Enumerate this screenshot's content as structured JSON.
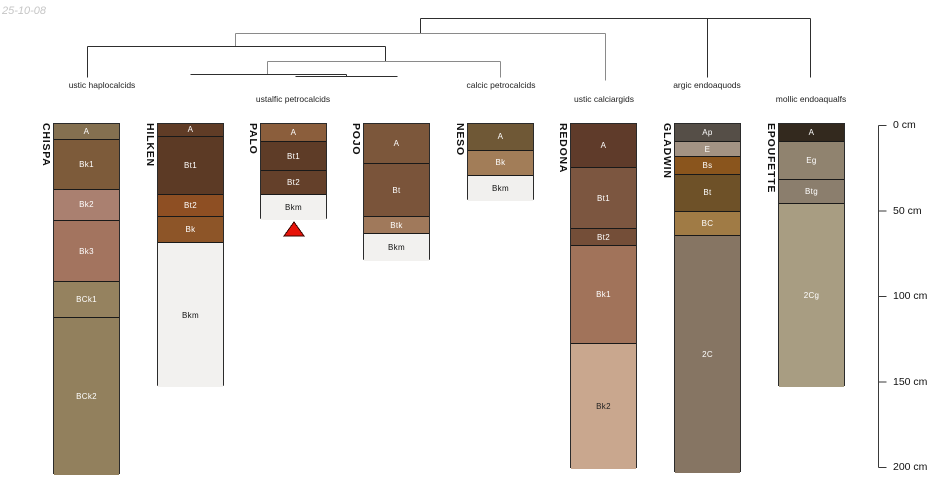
{
  "meta": {
    "date_label": "25-10-08"
  },
  "chart_data": {
    "type": "dendrogram-soil-profiles",
    "title": "",
    "layout": {
      "profiles_top_px": 123,
      "px_per_cm": 1.71,
      "column_width_px": 67,
      "line_colors": {
        "dark": "#2e2e2e",
        "gray": "#8a8a8a"
      }
    },
    "dendrogram": {
      "segments": [
        {
          "x1": 420,
          "y1": 18,
          "x2": 810,
          "y2": 18,
          "c": "dark"
        },
        {
          "x1": 420,
          "y1": 18,
          "x2": 420,
          "y2": 33,
          "c": "dark"
        },
        {
          "x1": 707,
          "y1": 18,
          "x2": 707,
          "y2": 77,
          "c": "dark"
        },
        {
          "x1": 810,
          "y1": 18,
          "x2": 810,
          "y2": 77,
          "c": "dark"
        },
        {
          "x1": 235,
          "y1": 33,
          "x2": 605,
          "y2": 33,
          "c": "gray"
        },
        {
          "x1": 235,
          "y1": 33,
          "x2": 235,
          "y2": 46,
          "c": "gray"
        },
        {
          "x1": 605,
          "y1": 33,
          "x2": 605,
          "y2": 80,
          "c": "gray"
        },
        {
          "x1": 87,
          "y1": 46,
          "x2": 385,
          "y2": 46,
          "c": "dark"
        },
        {
          "x1": 87,
          "y1": 46,
          "x2": 87,
          "y2": 77,
          "c": "dark"
        },
        {
          "x1": 385,
          "y1": 46,
          "x2": 385,
          "y2": 61,
          "c": "dark"
        },
        {
          "x1": 267,
          "y1": 61,
          "x2": 500,
          "y2": 61,
          "c": "gray"
        },
        {
          "x1": 500,
          "y1": 61,
          "x2": 500,
          "y2": 77,
          "c": "gray"
        },
        {
          "x1": 267,
          "y1": 61,
          "x2": 267,
          "y2": 74,
          "c": "gray"
        },
        {
          "x1": 190,
          "y1": 74,
          "x2": 346,
          "y2": 74,
          "c": "dark"
        },
        {
          "x1": 346,
          "y1": 74,
          "x2": 346,
          "y2": 76,
          "c": "dark"
        },
        {
          "x1": 295,
          "y1": 76,
          "x2": 397,
          "y2": 76,
          "c": "dark"
        }
      ]
    },
    "taxa": [
      {
        "label": "ustic haplocalcids",
        "cx": 102,
        "row": 0
      },
      {
        "label": "ustalfic petrocalcids",
        "cx": 293,
        "row": 1
      },
      {
        "label": "calcic petrocalcids",
        "cx": 501,
        "row": 0
      },
      {
        "label": "ustic calciargids",
        "cx": 604,
        "row": 1
      },
      {
        "label": "argic endoaquods",
        "cx": 707,
        "row": 0
      },
      {
        "label": "mollic endoaqualfs",
        "cx": 811,
        "row": 1
      }
    ],
    "taxa_row_tops": [
      80,
      94
    ],
    "profiles": [
      {
        "name": "CHISPA",
        "x": 53,
        "bottom_style": "soil",
        "horizons": [
          {
            "n": "A",
            "t": 0,
            "b": 9,
            "c": "#847050",
            "tc": "#ffffff"
          },
          {
            "n": "Bk1",
            "t": 9,
            "b": 38,
            "c": "#7d5b3a",
            "tc": "#ffffff"
          },
          {
            "n": "Bk2",
            "t": 38,
            "b": 56,
            "c": "#aa8070",
            "tc": "#ffffff"
          },
          {
            "n": "Bk3",
            "t": 56,
            "b": 92,
            "c": "#a3745f",
            "tc": "#ffffff"
          },
          {
            "n": "BCk1",
            "t": 92,
            "b": 113,
            "c": "#95825f",
            "tc": "#ffffff"
          },
          {
            "n": "BCk2",
            "t": 113,
            "b": 205,
            "c": "#92805d",
            "tc": "#ffffff"
          }
        ]
      },
      {
        "name": "HILKEN",
        "x": 157,
        "bottom_style": "bkm",
        "horizons": [
          {
            "n": "A",
            "t": 0,
            "b": 7,
            "c": "#603c26",
            "tc": "#ffffff"
          },
          {
            "n": "Bt1",
            "t": 7,
            "b": 41,
            "c": "#5c3a25",
            "tc": "#ffffff"
          },
          {
            "n": "Bt2",
            "t": 41,
            "b": 54,
            "c": "#8e4f23",
            "tc": "#ffffff"
          },
          {
            "n": "Bk",
            "t": 54,
            "b": 69,
            "c": "#8d5528",
            "tc": "#ffffff"
          },
          {
            "n": "Bkm",
            "t": 69,
            "b": 154,
            "c": "#f2f1ef",
            "tc": "#111111"
          }
        ]
      },
      {
        "name": "PALO",
        "x": 260,
        "bottom_style": "bkm",
        "horizons": [
          {
            "n": "A",
            "t": 0,
            "b": 10,
            "c": "#8b5e3c",
            "tc": "#ffffff"
          },
          {
            "n": "Bt1",
            "t": 10,
            "b": 27,
            "c": "#5e3c27",
            "tc": "#ffffff"
          },
          {
            "n": "Bt2",
            "t": 27,
            "b": 41,
            "c": "#64402a",
            "tc": "#ffffff"
          },
          {
            "n": "Bkm",
            "t": 41,
            "b": 56,
            "c": "#f2f1ef",
            "tc": "#111111"
          }
        ]
      },
      {
        "name": "POJO",
        "x": 363,
        "bottom_style": "bkm",
        "horizons": [
          {
            "n": "A",
            "t": 0,
            "b": 23,
            "c": "#7c573b",
            "tc": "#ffffff"
          },
          {
            "n": "Bt",
            "t": 23,
            "b": 54,
            "c": "#7a543a",
            "tc": "#ffffff"
          },
          {
            "n": "Btk",
            "t": 54,
            "b": 64,
            "c": "#a0795b",
            "tc": "#ffffff"
          },
          {
            "n": "Bkm",
            "t": 64,
            "b": 80,
            "c": "#f2f1ef",
            "tc": "#111111"
          }
        ]
      },
      {
        "name": "NESO",
        "x": 467,
        "bottom_style": "bkm",
        "horizons": [
          {
            "n": "A",
            "t": 0,
            "b": 15,
            "c": "#6f5836",
            "tc": "#ffffff"
          },
          {
            "n": "Bk",
            "t": 15,
            "b": 30,
            "c": "#a27d58",
            "tc": "#ffffff"
          },
          {
            "n": "Bkm",
            "t": 30,
            "b": 45,
            "c": "#f1f0ee",
            "tc": "#111111"
          }
        ]
      },
      {
        "name": "REDONA",
        "x": 570,
        "bottom_style": "soil",
        "horizons": [
          {
            "n": "A",
            "t": 0,
            "b": 25,
            "c": "#5f3b2a",
            "tc": "#ffffff"
          },
          {
            "n": "Bt1",
            "t": 25,
            "b": 61,
            "c": "#7c5640",
            "tc": "#ffffff"
          },
          {
            "n": "Bt2",
            "t": 61,
            "b": 71,
            "c": "#744e38",
            "tc": "#ffffff"
          },
          {
            "n": "Bk1",
            "t": 71,
            "b": 128,
            "c": "#a1735a",
            "tc": "#ffffff"
          },
          {
            "n": "Bk2",
            "t": 128,
            "b": 202,
            "c": "#c9a78e",
            "tc": "#222222"
          }
        ]
      },
      {
        "name": "GLADWIN",
        "x": 674,
        "bottom_style": "soil",
        "horizons": [
          {
            "n": "Ap",
            "t": 0,
            "b": 10,
            "c": "#554e47",
            "tc": "#ffffff"
          },
          {
            "n": "E",
            "t": 10,
            "b": 19,
            "c": "#a39384",
            "tc": "#ffffff"
          },
          {
            "n": "Bs",
            "t": 19,
            "b": 29,
            "c": "#8a551d",
            "tc": "#ffffff"
          },
          {
            "n": "Bt",
            "t": 29,
            "b": 51,
            "c": "#6e5128",
            "tc": "#ffffff"
          },
          {
            "n": "BC",
            "t": 51,
            "b": 65,
            "c": "#a07b45",
            "tc": "#ffffff"
          },
          {
            "n": "2C",
            "t": 65,
            "b": 204,
            "c": "#867563",
            "tc": "#ffffff"
          }
        ]
      },
      {
        "name": "EPOUFETTE",
        "x": 778,
        "bottom_style": "soil",
        "horizons": [
          {
            "n": "A",
            "t": 0,
            "b": 10,
            "c": "#33291e",
            "tc": "#ffffff"
          },
          {
            "n": "Eg",
            "t": 10,
            "b": 32,
            "c": "#90836f",
            "tc": "#ffffff"
          },
          {
            "n": "Btg",
            "t": 32,
            "b": 46,
            "c": "#8b7e6d",
            "tc": "#ffffff"
          },
          {
            "n": "2Cg",
            "t": 46,
            "b": 154,
            "c": "#a89d82",
            "tc": "#ffffff"
          }
        ]
      }
    ],
    "marker": {
      "shape": "triangle-up",
      "points": [
        [
          294,
          222
        ],
        [
          284,
          236
        ],
        [
          304,
          236
        ]
      ],
      "fill": "#e81309",
      "stroke": "#3c0500"
    },
    "depth_axis": {
      "unit": "cm",
      "x": 878,
      "y_top": 125,
      "y_bottom": 467,
      "tick_len": 8,
      "label_x": 893,
      "axis_color": "#3a3a3a",
      "label_color": "#111111",
      "ticks": [
        {
          "cm": 0,
          "label": "0 cm"
        },
        {
          "cm": 50,
          "label": "50 cm"
        },
        {
          "cm": 100,
          "label": "100 cm"
        },
        {
          "cm": 150,
          "label": "150 cm"
        },
        {
          "cm": 200,
          "label": "200 cm"
        }
      ]
    }
  }
}
